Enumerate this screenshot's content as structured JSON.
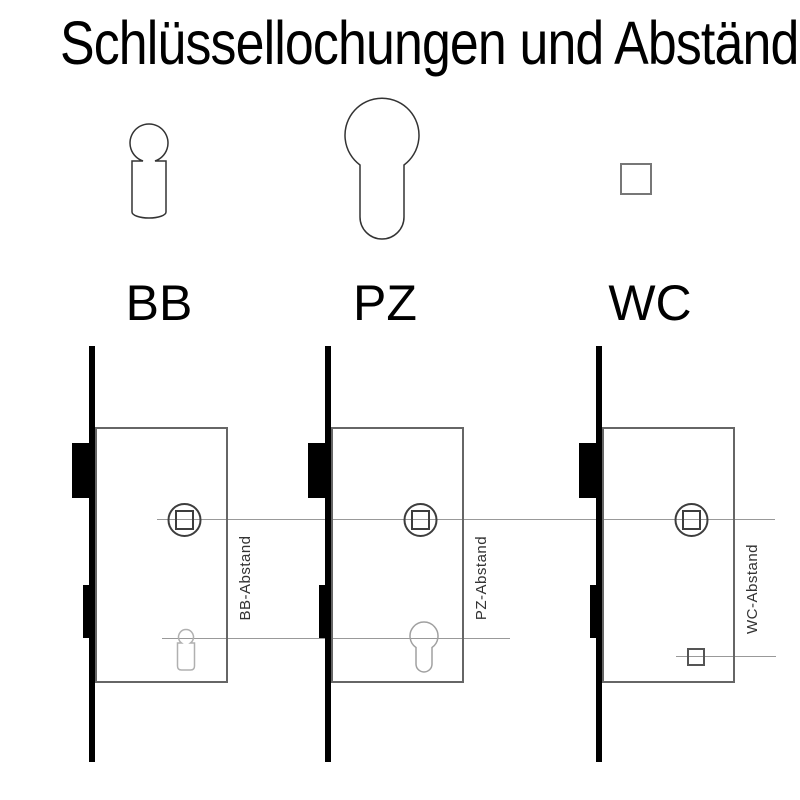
{
  "title": "Schlüssellochungen und Abstände",
  "legend": {
    "items": [
      {
        "id": "bb",
        "label": "BB",
        "icon": "bb-keyhole-icon"
      },
      {
        "id": "pz",
        "label": "PZ",
        "icon": "pz-profile-cylinder-icon"
      },
      {
        "id": "wc",
        "label": "WC",
        "icon": "wc-square-icon"
      }
    ]
  },
  "locks": [
    {
      "id": "bb",
      "keyhole_type": "BB",
      "distance_label": "BB-Abstand"
    },
    {
      "id": "pz",
      "keyhole_type": "PZ",
      "distance_label": "PZ-Abstand"
    },
    {
      "id": "wc",
      "keyhole_type": "WC",
      "distance_label": "WC-Abstand"
    }
  ],
  "colors": {
    "background": "#ffffff",
    "text": "#000000",
    "lock_hardware": "#000000",
    "case_outline": "#666666",
    "follower_outline": "#3d3d3d",
    "axis_line": "#999999",
    "keyhole_outline_light": "#b0b0b0"
  }
}
